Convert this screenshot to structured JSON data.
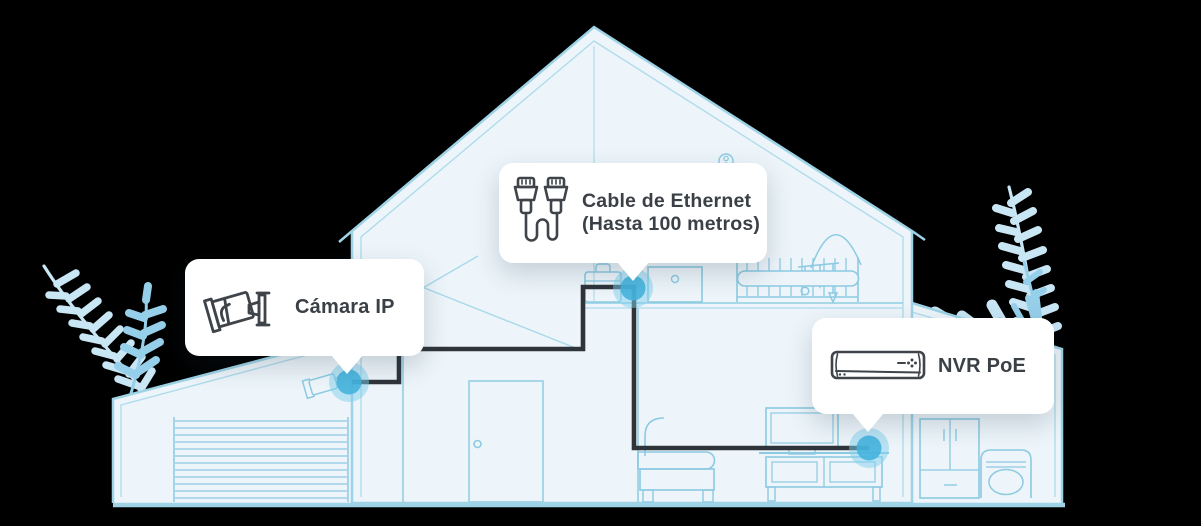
{
  "callouts": {
    "camera": {
      "label": "Cámara IP",
      "icon": "bullet-camera-icon"
    },
    "ethernet": {
      "label_line1": "Cable de Ethernet",
      "label_line2": "(Hasta 100 metros)",
      "icon": "ethernet-cable-icon"
    },
    "nvr": {
      "label": "NVR PoE",
      "icon": "nvr-recorder-icon"
    }
  },
  "markers": [
    {
      "name": "camera-mount-point"
    },
    {
      "name": "ethernet-junction-point"
    },
    {
      "name": "nvr-connection-point"
    }
  ],
  "colors": {
    "background": "#000000",
    "house_fill": "#edf5fa",
    "house_line": "#9ed3e6",
    "furniture_line": "#8ccae2",
    "cable": "#2f343a",
    "marker_core": "#43b2dc",
    "marker_halo": "#7fd0ec",
    "callout_bg": "#ffffff",
    "callout_text": "#3b4046",
    "plant_light": "#c9e6f5",
    "plant_medium": "#96cfea"
  }
}
